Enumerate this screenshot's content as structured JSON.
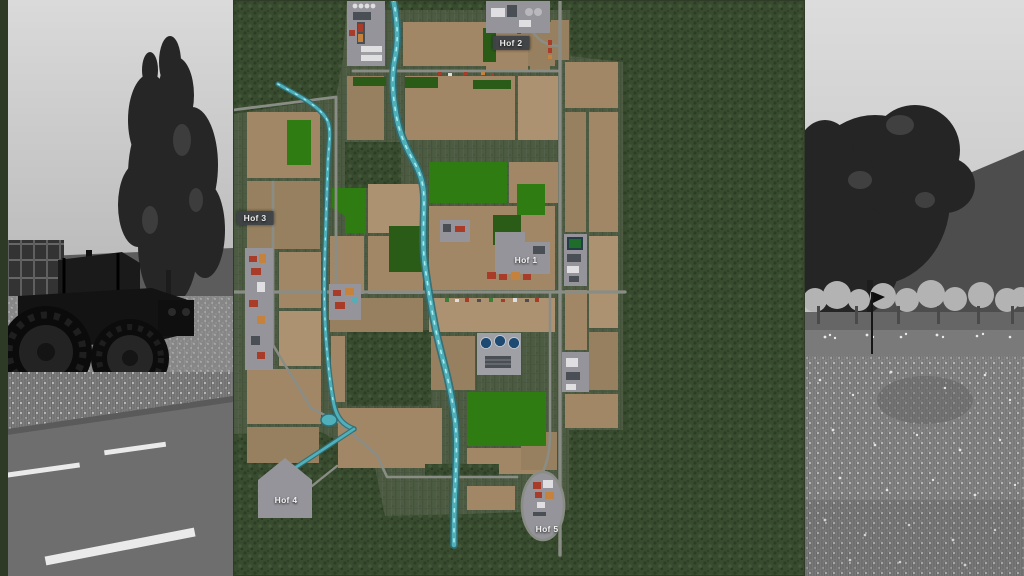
{
  "map": {
    "labels": [
      {
        "id": "hof-1",
        "label": "Hof 1",
        "x": 293,
        "y": 260,
        "boxed": false
      },
      {
        "id": "hof-2",
        "label": "Hof 2",
        "x": 278,
        "y": 43,
        "boxed": true
      },
      {
        "id": "hof-3",
        "label": "Hof 3",
        "x": 22,
        "y": 218,
        "boxed": true
      },
      {
        "id": "hof-4",
        "label": "Hof 4",
        "x": 53,
        "y": 500,
        "boxed": false
      },
      {
        "id": "hof-5",
        "label": "Hof 5",
        "x": 314,
        "y": 529,
        "boxed": false
      }
    ]
  },
  "palette": {
    "field_tan": "#a28766",
    "field_tan_dark": "#97805f",
    "field_tan_light": "#ad9271",
    "crop_green_bright": "#2e7c12",
    "crop_green_dark": "#2a5c17",
    "river_teal": "#4fb0ba",
    "river_deep": "#2f6e78",
    "river_light": "#a8ecef",
    "road_gray": "#8a8d86",
    "farmyard_gray": "#94949a",
    "label_bg": "#3f4347",
    "label_text": "#f2f2f2",
    "building_red": "#a83c28",
    "building_orange": "#c4823c",
    "building_white": "#dfdfe2",
    "building_dark": "#4a4e55",
    "water_blue": "#1d4a72"
  }
}
